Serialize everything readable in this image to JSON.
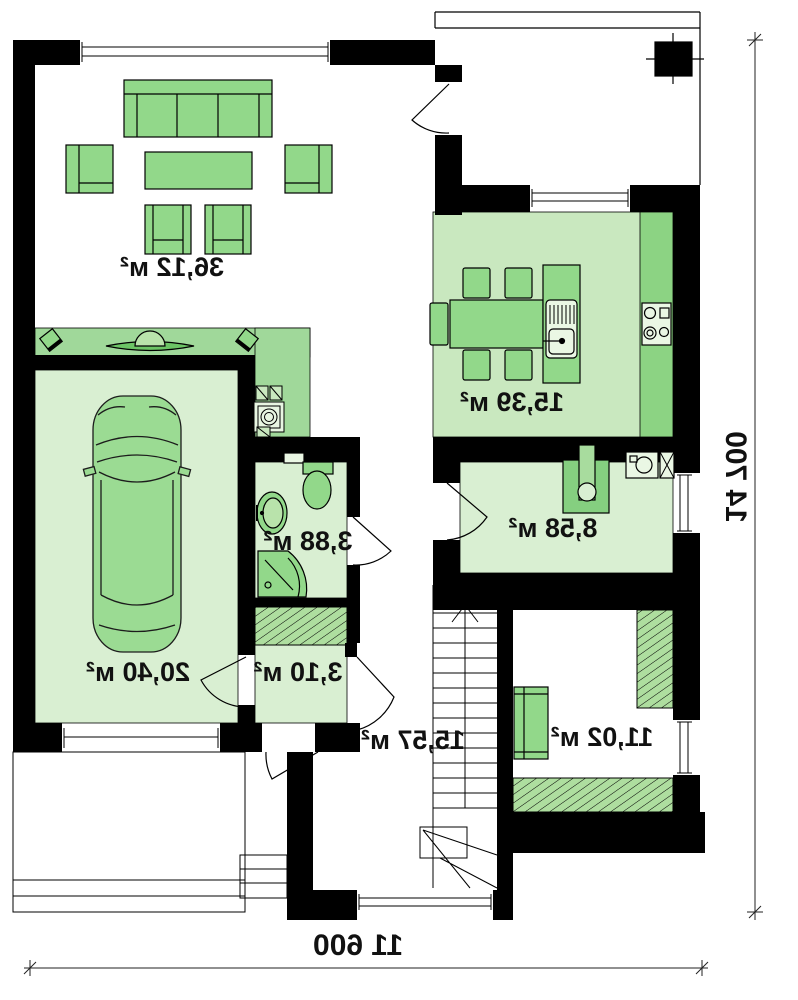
{
  "plan": {
    "type": "floor-plan",
    "mirrored": true,
    "rooms": [
      {
        "id": "living-room",
        "area_label": "36,12 м²"
      },
      {
        "id": "kitchen-dining",
        "area_label": "15,39 м²"
      },
      {
        "id": "utility-room",
        "area_label": "8,58 м²"
      },
      {
        "id": "bathroom",
        "area_label": "3,88 м²"
      },
      {
        "id": "hall",
        "area_label": "3,10 м²"
      },
      {
        "id": "garage",
        "area_label": "20,40 м²"
      },
      {
        "id": "corridor-stairs",
        "area_label": "15,57 м²"
      },
      {
        "id": "bedroom",
        "area_label": "11,02 м²"
      }
    ],
    "dimensions": {
      "width_label": "11 600",
      "height_label": "14 700"
    },
    "colors": {
      "wall": "#000000",
      "floor_light": "#d9efd2",
      "floor_kitchen": "#c9e8bf",
      "zone_accent": "#a0d89a",
      "counter": "#8cd383",
      "furniture": "#92d88a",
      "hatch_base": "#aede9f"
    }
  }
}
